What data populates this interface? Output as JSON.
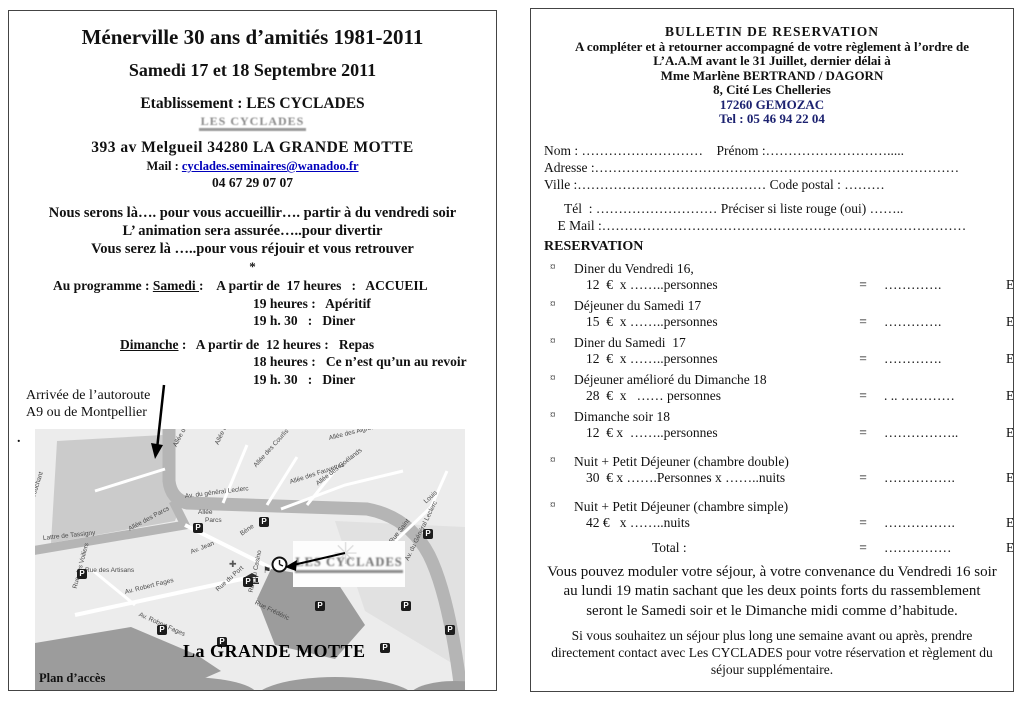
{
  "left_page": {
    "title": "Ménerville 30 ans d’amitiés 1981-2011",
    "subtitle": "Samedi  17 et 18 Septembre  2011",
    "establishment": "Etablissement : LES CYCLADES",
    "logo_text": "LES CYCLADES",
    "address": "393  av  Melgueil  34280   LA GRANDE  MOTTE",
    "mail_label": "Mail : ",
    "mail_link": "cyclades.seminaires@wanadoo.fr",
    "phone": "04 67 29 07 07",
    "intro_lines": [
      "Nous serons là…. pour vous accueillir….  partir à du vendredi soir",
      "L’ animation sera assurée…..pour divertir",
      "Vous serez là …..pour vous réjouir et vous retrouver"
    ],
    "star": "*",
    "program_rows": [
      {
        "indent": 28,
        "parts": [
          {
            "t": "Au programme : "
          },
          {
            "t": "Samedi ",
            "u": true
          },
          {
            "t": ":    A partir de  17 heures   :   ACCUEIL"
          }
        ]
      },
      {
        "indent": 228,
        "parts": [
          {
            "t": "19 heures :   Apéritif"
          }
        ]
      },
      {
        "indent": 228,
        "parts": [
          {
            "t": "19 h. 30   :   Diner"
          }
        ]
      },
      {
        "indent": 95,
        "gap_before": true,
        "parts": [
          {
            "t": "Dimanche",
            "u": true
          },
          {
            "t": " :   A partir de  12 heures :   Repas"
          }
        ]
      },
      {
        "indent": 228,
        "parts": [
          {
            "t": "18 heures :   Ce n’est qu’un au revoir"
          }
        ]
      },
      {
        "indent": 228,
        "parts": [
          {
            "t": "19 h. 30   :   Diner"
          }
        ]
      }
    ],
    "arrival_note": [
      "Arrivée de l’autoroute",
      "A9   ou de Montpellier"
    ],
    "stray_dot": ".",
    "map": {
      "cyclades_logo": "LES CYCLADES",
      "city_label": "La GRANDE MOTTE",
      "caption": "Plan d’accès",
      "parking_letter": "P",
      "labels": [
        {
          "t": "Couchant",
          "x": -2,
          "y": 66,
          "r": -72
        },
        {
          "t": "Lattre de Tassigny",
          "x": 8,
          "y": 106,
          "r": -6
        },
        {
          "t": "Allée des Parcs",
          "x": 94,
          "y": 97,
          "r": -28
        },
        {
          "t": "Av. du général Leclerc",
          "x": 150,
          "y": 64,
          "r": -7
        },
        {
          "t": "Allée",
          "x": 163,
          "y": 80,
          "r": 0
        },
        {
          "t": "Parcs",
          "x": 170,
          "y": 88,
          "r": 0
        },
        {
          "t": "Allée des Bergeronnettes",
          "x": 140,
          "y": 14,
          "r": -62
        },
        {
          "t": "Allée des Palombes",
          "x": 182,
          "y": 12,
          "r": -65
        },
        {
          "t": "Av. Jean",
          "x": 156,
          "y": 120,
          "r": -22
        },
        {
          "t": "Bène",
          "x": 206,
          "y": 102,
          "r": -35
        },
        {
          "t": "Allée des Courlis",
          "x": 220,
          "y": 34,
          "r": -48
        },
        {
          "t": "Allée des Fauvettes",
          "x": 255,
          "y": 50,
          "r": -18
        },
        {
          "t": "Allée des Goélands",
          "x": 282,
          "y": 52,
          "r": -38
        },
        {
          "t": "Allée des Aigrettes",
          "x": 294,
          "y": 6,
          "r": -14
        },
        {
          "t": "Rue Saint",
          "x": 356,
          "y": 110,
          "r": -52
        },
        {
          "t": "Louis",
          "x": 390,
          "y": 70,
          "r": -42
        },
        {
          "t": "Rue des Artisans",
          "x": 50,
          "y": 138,
          "r": 0
        },
        {
          "t": "Rue des Voiliers",
          "x": 40,
          "y": 156,
          "r": -75
        },
        {
          "t": "Av. Robert Fages",
          "x": 90,
          "y": 160,
          "r": -14
        },
        {
          "t": "Av. Robert Fages",
          "x": 104,
          "y": 182,
          "r": 24
        },
        {
          "t": "Rue du Port",
          "x": 182,
          "y": 158,
          "r": -42
        },
        {
          "t": "Rue du Casino",
          "x": 216,
          "y": 160,
          "r": -78
        },
        {
          "t": "Rue Frédéric",
          "x": 220,
          "y": 170,
          "r": 26
        },
        {
          "t": "Av. du Général Leclerc",
          "x": 372,
          "y": 128,
          "r": -64
        }
      ],
      "parkings": [
        [
          158,
          94
        ],
        [
          224,
          88
        ],
        [
          388,
          100
        ],
        [
          42,
          140
        ],
        [
          122,
          196
        ],
        [
          208,
          148
        ],
        [
          280,
          172
        ],
        [
          366,
          172
        ],
        [
          410,
          196
        ],
        [
          345,
          214
        ],
        [
          182,
          208
        ]
      ]
    }
  },
  "right_page": {
    "header_lines": [
      {
        "text": "BULLETIN   DE   RESERVATION",
        "navy": false
      },
      {
        "text": "A compléter et à retourner accompagné de votre règlement à l’ordre de",
        "navy": false
      },
      {
        "text": "L’A.A.M   avant le  31 Juillet, dernier délai à",
        "navy": false
      },
      {
        "text": "Mme Marlène BERTRAND / DAGORN",
        "navy": false
      },
      {
        "text": "8, Cité Les Chelleries",
        "navy": false
      },
      {
        "text": "17260   GEMOZAC",
        "navy": true
      },
      {
        "text": "Tel :  05 46  94 22 04",
        "navy": true
      }
    ],
    "form_lines": [
      {
        "text": "Nom : ………………………    Prénom :……………………….....",
        "gap_after": false
      },
      {
        "text": "Adresse :………………………………………………………………………",
        "gap_after": false
      },
      {
        "text": "Ville :…………………………………… Code postal : ………",
        "gap_after": true
      },
      {
        "text": "      Tél  : ……………………… Préciser si liste rouge (oui) ……..",
        "gap_after": false
      },
      {
        "text": "    E Mail :………………………………………………………………………",
        "gap_after": false
      }
    ],
    "reservation_heading": "RESERVATION",
    "items": [
      {
        "bullet": "¤",
        "label": "Diner du Vendredi 16,",
        "qty": "12  €  x ……..personnes",
        "eq": "=",
        "dots": "………….",
        "unit": "Euros",
        "big_gap": false
      },
      {
        "bullet": "¤",
        "label": "Déjeuner du Samedi 17",
        "qty": "15  €  x ……..personnes",
        "eq": "=",
        "dots": "………….",
        "unit": "Euros",
        "big_gap": false
      },
      {
        "bullet": "¤",
        "label": "Diner du Samedi  17",
        "qty": "12  €  x ……..personnes",
        "eq": "=",
        "dots": "………….",
        "unit": "Euros",
        "big_gap": false
      },
      {
        "bullet": "¤",
        "label": "Déjeuner amélioré du Dimanche 18",
        "qty": "28  €  x   …… personnes",
        "eq": "=",
        "dots": ". .. …………",
        "unit": "Euros",
        "big_gap": false
      },
      {
        "bullet": "¤",
        "label": "Dimanche soir 18",
        "qty": "12  € x  ……..personnes",
        "eq": "=",
        "dots": "……………..",
        "unit": "Euros",
        "big_gap": false
      },
      {
        "bullet": "¤",
        "label": "Nuit + Petit Déjeuner (chambre double)",
        "qty": "30  € x …….Personnes x ……..nuits",
        "eq": "=",
        "dots": "…………….",
        "unit": "Euros",
        "big_gap": true
      },
      {
        "bullet": "¤",
        "label": "Nuit + Petit Déjeuner (chambre simple)",
        "qty": "42 €   x ……..nuits",
        "eq": "=",
        "dots": "…………….",
        "unit": "Euros",
        "big_gap": true
      }
    ],
    "total": {
      "label": "Total :",
      "eq": "=",
      "dots": "……………",
      "unit": "Euros"
    },
    "closing_1": "Vous pouvez moduler votre séjour, à votre convenance du Vendredi 16 soir au lundi 19 matin sachant que les deux points forts du rassemblement seront le Samedi soir et le Dimanche midi comme d’habitude.",
    "closing_2": "Si vous souhaitez un séjour plus long une semaine avant ou après, prendre directement contact avec Les CYCLADES pour votre réservation et règlement du séjour supplémentaire."
  },
  "colors": {
    "navy": "#1c2270",
    "link_blue": "#0000bb",
    "map_bg": "#ececec",
    "map_road": "#b5b5b5",
    "map_dark": "#9c9c9c"
  }
}
